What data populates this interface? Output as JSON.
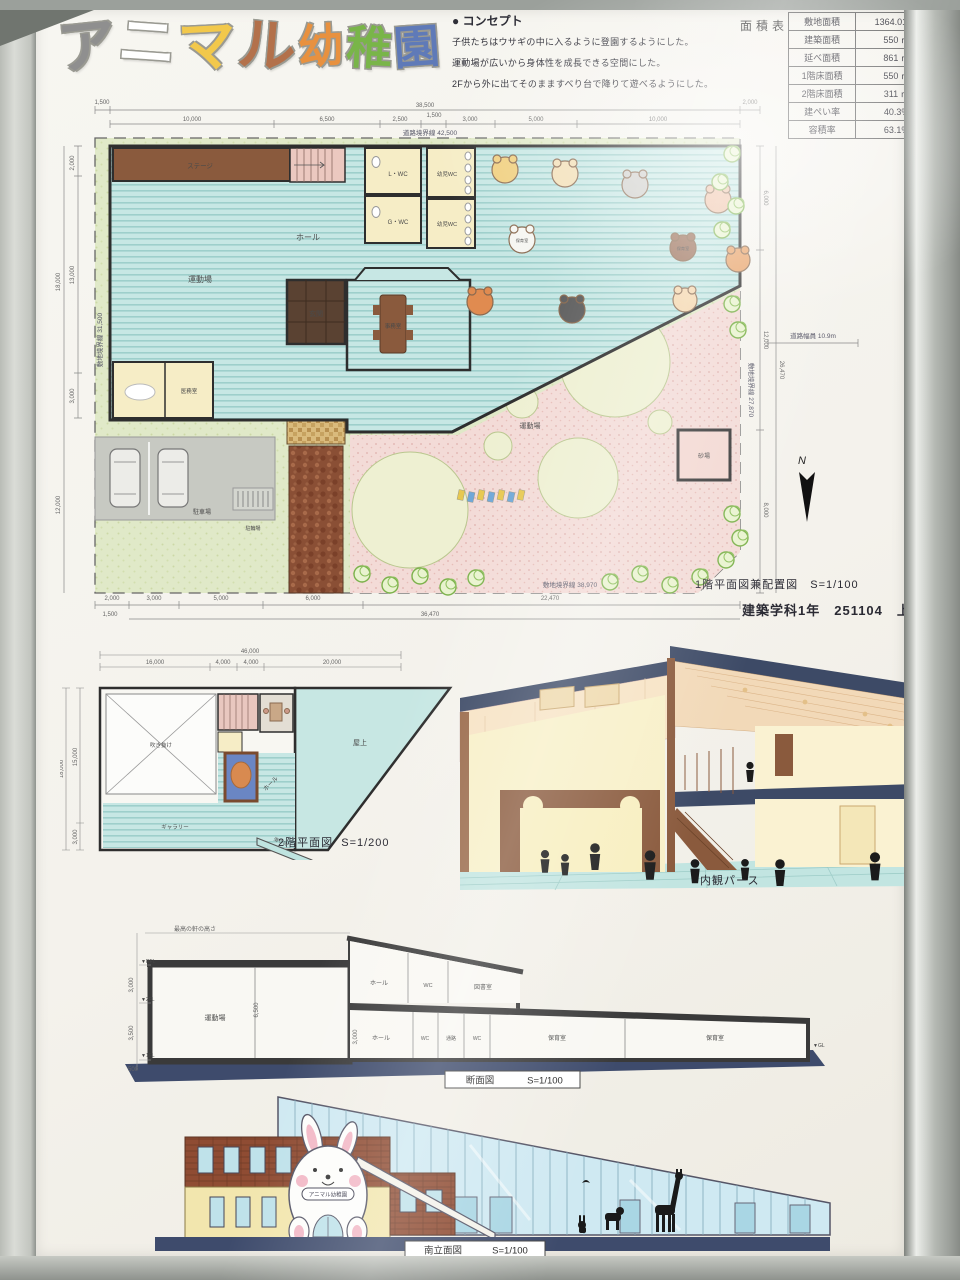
{
  "title": {
    "text": "アニマル幼稚園",
    "chars": [
      {
        "ch": "ア",
        "color": "#8f8f8f"
      },
      {
        "ch": "ニ",
        "color": "#ffffff"
      },
      {
        "ch": "マ",
        "color": "#f2c84b"
      },
      {
        "ch": "ル",
        "color": "#b3714b"
      },
      {
        "ch": "幼",
        "color": "#e8913f"
      },
      {
        "ch": "稚",
        "color": "#79b549"
      },
      {
        "ch": "園",
        "color": "#5f7ab8"
      }
    ]
  },
  "concept": {
    "heading": "● コンセプト",
    "lines": [
      "子供たちはウサギの中に入るように登園するようにした。",
      "運動場が広いから身体性を成長できる空間にした。",
      "2Fから外に出てそのまますべり台で降りて遊べるようにした。"
    ]
  },
  "area_table": {
    "title": "面積表",
    "rows": [
      {
        "label": "敷地面積",
        "value": "1364.01 ㎡"
      },
      {
        "label": "建築面積",
        "value": "550 ㎡"
      },
      {
        "label": "延べ面積",
        "value": "861 ㎡"
      },
      {
        "label": "1階床面積",
        "value": "550 ㎡"
      },
      {
        "label": "2階床面積",
        "value": "311 ㎡"
      },
      {
        "label": "建ぺい率",
        "value": "40.3%"
      },
      {
        "label": "容積率",
        "value": "63.1%"
      }
    ]
  },
  "author": {
    "line": "建築学科1年　251104　上原理緒"
  },
  "plan1f": {
    "caption": "1階平面図兼配置図",
    "scale": "S=1/100",
    "north": "N",
    "rooms": {
      "stage": "ステージ",
      "gym": "運動場",
      "hall": "ホール",
      "lwc": "L・WC",
      "gwc": "G・WC",
      "kids_wc": "幼児WC",
      "office": "事務室",
      "entrance": "玄関",
      "medical": "医務室",
      "nursery": "保育室",
      "sandbox": "砂場",
      "parking": "駐車場",
      "bicycle": "駐輪場",
      "playground": "運動場"
    },
    "boundaries": {
      "top": "道路境界線 42,500",
      "left": "敷地境界線 31,500",
      "right": "敷地境界線 27,870",
      "bottom": "敷地境界線 38,970",
      "road": "道路幅員 10.9m"
    },
    "dims": {
      "top_offset": "1,500",
      "top_total": "38,500",
      "top_right": "2,000",
      "top_segs": [
        "10,000",
        "6,500",
        "2,500",
        "1,500",
        "3,000",
        "5,000",
        "10,000"
      ],
      "left_offset": "1,500",
      "left_total": "18,000",
      "left_segs": [
        "2,000",
        "13,000",
        "3,000"
      ],
      "left_lower": "12,000",
      "right_segs": [
        "6,000",
        "12,000",
        "8,000"
      ],
      "right_total": "26,470",
      "bottom_offset": "1,500",
      "bottom_segs": [
        "2,000",
        "3,000",
        "5,000",
        "6,000",
        "22,470"
      ],
      "bottom_total": "36,470"
    }
  },
  "plan2f": {
    "caption": "2階平面図",
    "scale": "S=1/200",
    "rooms": {
      "void": "吹き抜け",
      "hall": "ホール",
      "roof": "屋上",
      "gallery": "ギャラリー",
      "slide": "滑り台"
    },
    "dims": {
      "top_total": "46,000",
      "top_segs": [
        "16,000",
        "4,000",
        "4,000",
        "20,000"
      ],
      "left_total": "18,000",
      "left_segs": [
        "15,000",
        "3,000"
      ]
    }
  },
  "perspective": {
    "caption": "内観パース"
  },
  "section": {
    "caption": "断面図",
    "scale": "S=1/100",
    "note": "最高の軒の高さ",
    "levels": {
      "rfl": "▼RFL",
      "fl2": "▼2FL",
      "fl1": "▼1FL",
      "gl": "▼GL"
    },
    "dims": {
      "upper": "3,000",
      "lower": "3,500",
      "base": "500",
      "gym_height": "6,500",
      "hall_height": "3,000"
    },
    "rooms_upper": [
      "ホール",
      "WC",
      "図書室"
    ],
    "rooms_lower": [
      "運動場",
      "ホール",
      "WC",
      "通路",
      "WC",
      "保育室",
      "保育室"
    ]
  },
  "elevation": {
    "caption": "南立面図",
    "scale": "S=1/100",
    "sign": "アニマル幼稚園"
  }
}
